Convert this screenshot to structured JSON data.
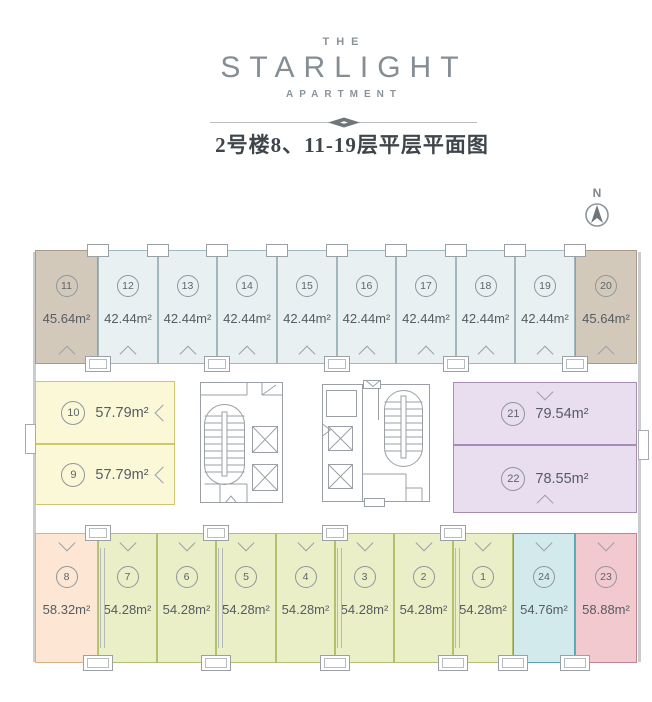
{
  "header": {
    "brand_top": "THE",
    "brand_main": "STARLIGHT",
    "brand_sub": "APARTMENT",
    "title": "2号楼8、11-19层平层平面图"
  },
  "compass": {
    "label": "N"
  },
  "palette": {
    "tan": {
      "fill": "#d3c9bb",
      "border": "#a89a89"
    },
    "blue": {
      "fill": "#e8f0f1",
      "border": "#9fb7bd"
    },
    "yellow": {
      "fill": "#fbf8d8",
      "border": "#cfc66d"
    },
    "purple": {
      "fill": "#e9def0",
      "border": "#a98bba"
    },
    "peach": {
      "fill": "#fde6d3",
      "border": "#dfae85"
    },
    "green": {
      "fill": "#eaefc8",
      "border": "#b4c16c"
    },
    "cyan": {
      "fill": "#d2eaec",
      "border": "#56a7b3"
    },
    "pink": {
      "fill": "#f1c9ce",
      "border": "#c8808b"
    }
  },
  "floorplan": {
    "units": [
      {
        "id": "11",
        "area": "45.64m²",
        "color": "tan",
        "x": 35,
        "y": 250,
        "w": 63,
        "h": 114,
        "layout": "stack",
        "door": "bottom"
      },
      {
        "id": "12",
        "area": "42.44m²",
        "color": "blue",
        "x": 98,
        "y": 250,
        "w": 60,
        "h": 114,
        "layout": "stack",
        "door": "bottom"
      },
      {
        "id": "13",
        "area": "42.44m²",
        "color": "blue",
        "x": 158,
        "y": 250,
        "w": 59,
        "h": 114,
        "layout": "stack",
        "door": "bottom"
      },
      {
        "id": "14",
        "area": "42.44m²",
        "color": "blue",
        "x": 217,
        "y": 250,
        "w": 60,
        "h": 114,
        "layout": "stack",
        "door": "bottom"
      },
      {
        "id": "15",
        "area": "42.44m²",
        "color": "blue",
        "x": 277,
        "y": 250,
        "w": 60,
        "h": 114,
        "layout": "stack",
        "door": "bottom"
      },
      {
        "id": "16",
        "area": "42.44m²",
        "color": "blue",
        "x": 337,
        "y": 250,
        "w": 59,
        "h": 114,
        "layout": "stack",
        "door": "bottom"
      },
      {
        "id": "17",
        "area": "42.44m²",
        "color": "blue",
        "x": 396,
        "y": 250,
        "w": 60,
        "h": 114,
        "layout": "stack",
        "door": "bottom"
      },
      {
        "id": "18",
        "area": "42.44m²",
        "color": "blue",
        "x": 456,
        "y": 250,
        "w": 59,
        "h": 114,
        "layout": "stack",
        "door": "bottom"
      },
      {
        "id": "19",
        "area": "42.44m²",
        "color": "blue",
        "x": 515,
        "y": 250,
        "w": 60,
        "h": 114,
        "layout": "stack",
        "door": "bottom"
      },
      {
        "id": "20",
        "area": "45.64m²",
        "color": "tan",
        "x": 575,
        "y": 250,
        "w": 62,
        "h": 114,
        "layout": "stack",
        "door": "bottom"
      },
      {
        "id": "10",
        "area": "57.79m²",
        "color": "yellow",
        "x": 35,
        "y": 381,
        "w": 140,
        "h": 63,
        "layout": "inline",
        "door": "right"
      },
      {
        "id": "9",
        "area": "57.79m²",
        "color": "yellow",
        "x": 35,
        "y": 444,
        "w": 140,
        "h": 61,
        "layout": "inline",
        "door": "right"
      },
      {
        "id": "21",
        "area": "79.54m²",
        "color": "purple",
        "x": 453,
        "y": 382,
        "w": 184,
        "h": 63,
        "layout": "inline",
        "door": "top"
      },
      {
        "id": "22",
        "area": "78.55m²",
        "color": "purple",
        "x": 453,
        "y": 445,
        "w": 184,
        "h": 68,
        "layout": "inline",
        "door": "bottom"
      },
      {
        "id": "8",
        "area": "58.32m²",
        "color": "peach",
        "x": 35,
        "y": 533,
        "w": 63,
        "h": 130,
        "layout": "stack",
        "door": "top"
      },
      {
        "id": "7",
        "area": "54.28m²",
        "color": "green",
        "x": 98,
        "y": 533,
        "w": 59,
        "h": 130,
        "layout": "stack",
        "door": "top"
      },
      {
        "id": "6",
        "area": "54.28m²",
        "color": "green",
        "x": 157,
        "y": 533,
        "w": 59,
        "h": 130,
        "layout": "stack",
        "door": "top"
      },
      {
        "id": "5",
        "area": "54.28m²",
        "color": "green",
        "x": 216,
        "y": 533,
        "w": 60,
        "h": 130,
        "layout": "stack",
        "door": "top"
      },
      {
        "id": "4",
        "area": "54.28m²",
        "color": "green",
        "x": 276,
        "y": 533,
        "w": 59,
        "h": 130,
        "layout": "stack",
        "door": "top"
      },
      {
        "id": "3",
        "area": "54.28m²",
        "color": "green",
        "x": 335,
        "y": 533,
        "w": 59,
        "h": 130,
        "layout": "stack",
        "door": "top"
      },
      {
        "id": "2",
        "area": "54.28m²",
        "color": "green",
        "x": 394,
        "y": 533,
        "w": 59,
        "h": 130,
        "layout": "stack",
        "door": "top"
      },
      {
        "id": "1",
        "area": "54.28m²",
        "color": "green",
        "x": 453,
        "y": 533,
        "w": 60,
        "h": 130,
        "layout": "stack",
        "door": "top"
      },
      {
        "id": "24",
        "area": "54.76m²",
        "color": "cyan",
        "x": 513,
        "y": 533,
        "w": 62,
        "h": 130,
        "layout": "stack",
        "door": "top"
      },
      {
        "id": "23",
        "area": "58.88m²",
        "color": "pink",
        "x": 575,
        "y": 533,
        "w": 62,
        "h": 130,
        "layout": "stack",
        "door": "top"
      }
    ],
    "utility_boxes": [
      {
        "x": 87,
        "y": 244,
        "w": 22,
        "h": 13,
        "double": false
      },
      {
        "x": 147,
        "y": 244,
        "w": 22,
        "h": 13,
        "double": false
      },
      {
        "x": 206,
        "y": 244,
        "w": 22,
        "h": 13,
        "double": false
      },
      {
        "x": 266,
        "y": 244,
        "w": 22,
        "h": 13,
        "double": false
      },
      {
        "x": 326,
        "y": 244,
        "w": 22,
        "h": 13,
        "double": false
      },
      {
        "x": 385,
        "y": 244,
        "w": 22,
        "h": 13,
        "double": false
      },
      {
        "x": 445,
        "y": 244,
        "w": 22,
        "h": 13,
        "double": false
      },
      {
        "x": 504,
        "y": 244,
        "w": 22,
        "h": 13,
        "double": false
      },
      {
        "x": 564,
        "y": 244,
        "w": 22,
        "h": 13,
        "double": false
      },
      {
        "x": 85,
        "y": 356,
        "w": 26,
        "h": 16,
        "double": true
      },
      {
        "x": 204,
        "y": 356,
        "w": 26,
        "h": 16,
        "double": true
      },
      {
        "x": 324,
        "y": 356,
        "w": 26,
        "h": 16,
        "double": true
      },
      {
        "x": 443,
        "y": 356,
        "w": 26,
        "h": 16,
        "double": true
      },
      {
        "x": 562,
        "y": 356,
        "w": 26,
        "h": 16,
        "double": true
      },
      {
        "x": 85,
        "y": 525,
        "w": 26,
        "h": 16,
        "double": true
      },
      {
        "x": 203,
        "y": 525,
        "w": 26,
        "h": 16,
        "double": true
      },
      {
        "x": 322,
        "y": 525,
        "w": 26,
        "h": 16,
        "double": true
      },
      {
        "x": 440,
        "y": 525,
        "w": 26,
        "h": 16,
        "double": true
      },
      {
        "x": 83,
        "y": 655,
        "w": 30,
        "h": 16,
        "double": true
      },
      {
        "x": 201,
        "y": 655,
        "w": 30,
        "h": 16,
        "double": true
      },
      {
        "x": 320,
        "y": 655,
        "w": 30,
        "h": 16,
        "double": true
      },
      {
        "x": 438,
        "y": 655,
        "w": 30,
        "h": 16,
        "double": true
      },
      {
        "x": 498,
        "y": 655,
        "w": 30,
        "h": 16,
        "double": true
      },
      {
        "x": 560,
        "y": 655,
        "w": 30,
        "h": 16,
        "double": true
      }
    ],
    "pipes": [
      {
        "x": 100,
        "y": 548,
        "h": 100
      },
      {
        "x": 218,
        "y": 548,
        "h": 100
      },
      {
        "x": 337,
        "y": 548,
        "h": 100
      },
      {
        "x": 455,
        "y": 548,
        "h": 100
      }
    ],
    "balconies": [
      {
        "x": 25,
        "y": 424,
        "w": 11,
        "h": 30
      },
      {
        "x": 638,
        "y": 430,
        "w": 11,
        "h": 30
      }
    ],
    "edge_walls": [
      {
        "x": 33,
        "y": 252,
        "w": 3,
        "h": 410
      },
      {
        "x": 638,
        "y": 252,
        "w": 3,
        "h": 410
      }
    ]
  }
}
